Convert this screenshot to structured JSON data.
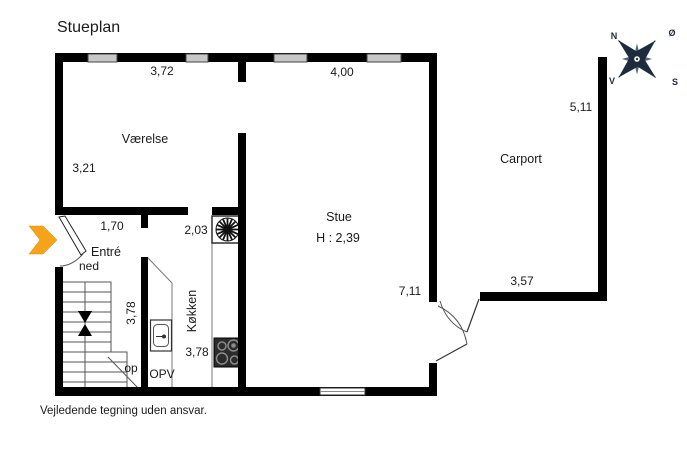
{
  "title": "Stueplan",
  "footer": "Vejledende tegning uden ansvar.",
  "rooms": {
    "vaerelse": "Værelse",
    "stue": "Stue",
    "stue_ceiling_height": "H : 2,39",
    "koekken": "Køkken",
    "entre": "Entré",
    "carport": "Carport",
    "dishwasher": "OPV"
  },
  "stairs": {
    "down_label": "ned",
    "up_label": "op"
  },
  "dimensions": {
    "vaerelse_width": "3,72",
    "stue_width": "4,00",
    "carport_depth": "5,11",
    "vaerelse_depth": "3,21",
    "entre_width": "1,70",
    "koekken_width": "2,03",
    "trappe_depth": "3,78",
    "koekken_depth": "3,78",
    "stue_depth": "7,11",
    "carport_width": "3,57"
  },
  "compass": {
    "north": "N",
    "east": "Ø",
    "south": "S",
    "west": "V"
  },
  "colors": {
    "wall": "#000000",
    "window_fill": "#c8c8c8",
    "entrance_arrow": "#F6A21B",
    "compass": "#1d2b3c",
    "text": "#1a1a1a"
  }
}
